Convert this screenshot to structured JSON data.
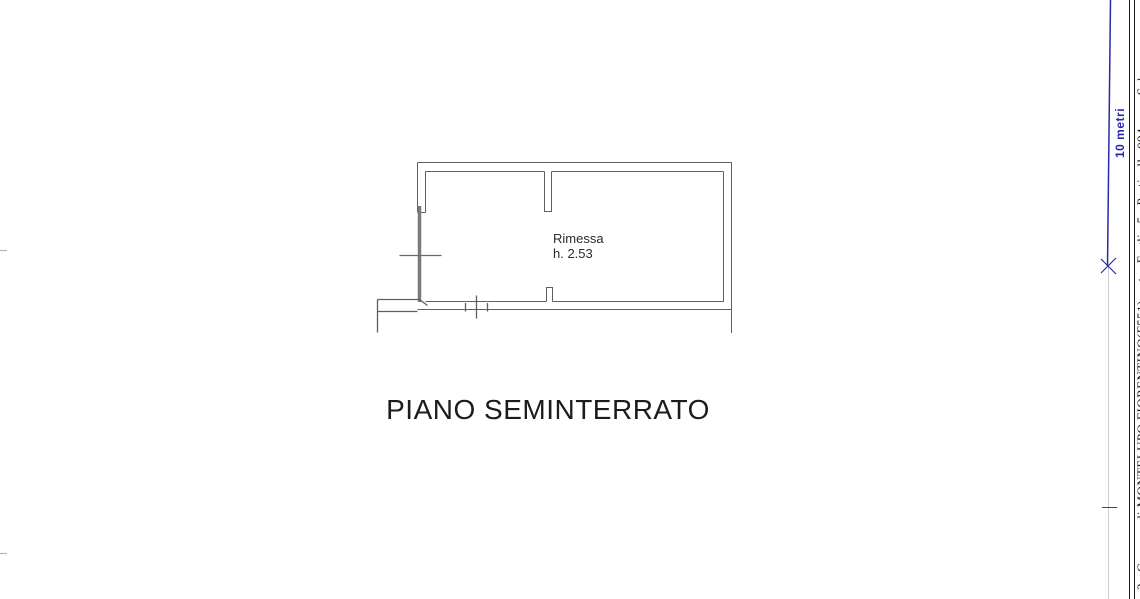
{
  "document": {
    "floor_plan": {
      "room": {
        "name": "Rimessa",
        "height_label": "h. 2.53"
      },
      "title": "PIANO SEMINTERRATO"
    },
    "scale_bar": {
      "label": "10 metri",
      "color": "#2a2aa8"
    },
    "margin_strip": {
      "text": "2   Comune di MONTELUPO FIORENTINO(F551)    <    Foglio 5   Particella 094         Sub"
    },
    "colors": {
      "plan_ink": "#5f5f5f",
      "wall_fill_ink": "#7a7a7a",
      "text_ink": "#2b2b2b",
      "accent_blue": "#2a2aa8",
      "border_ink": "#1a1a1a"
    }
  }
}
